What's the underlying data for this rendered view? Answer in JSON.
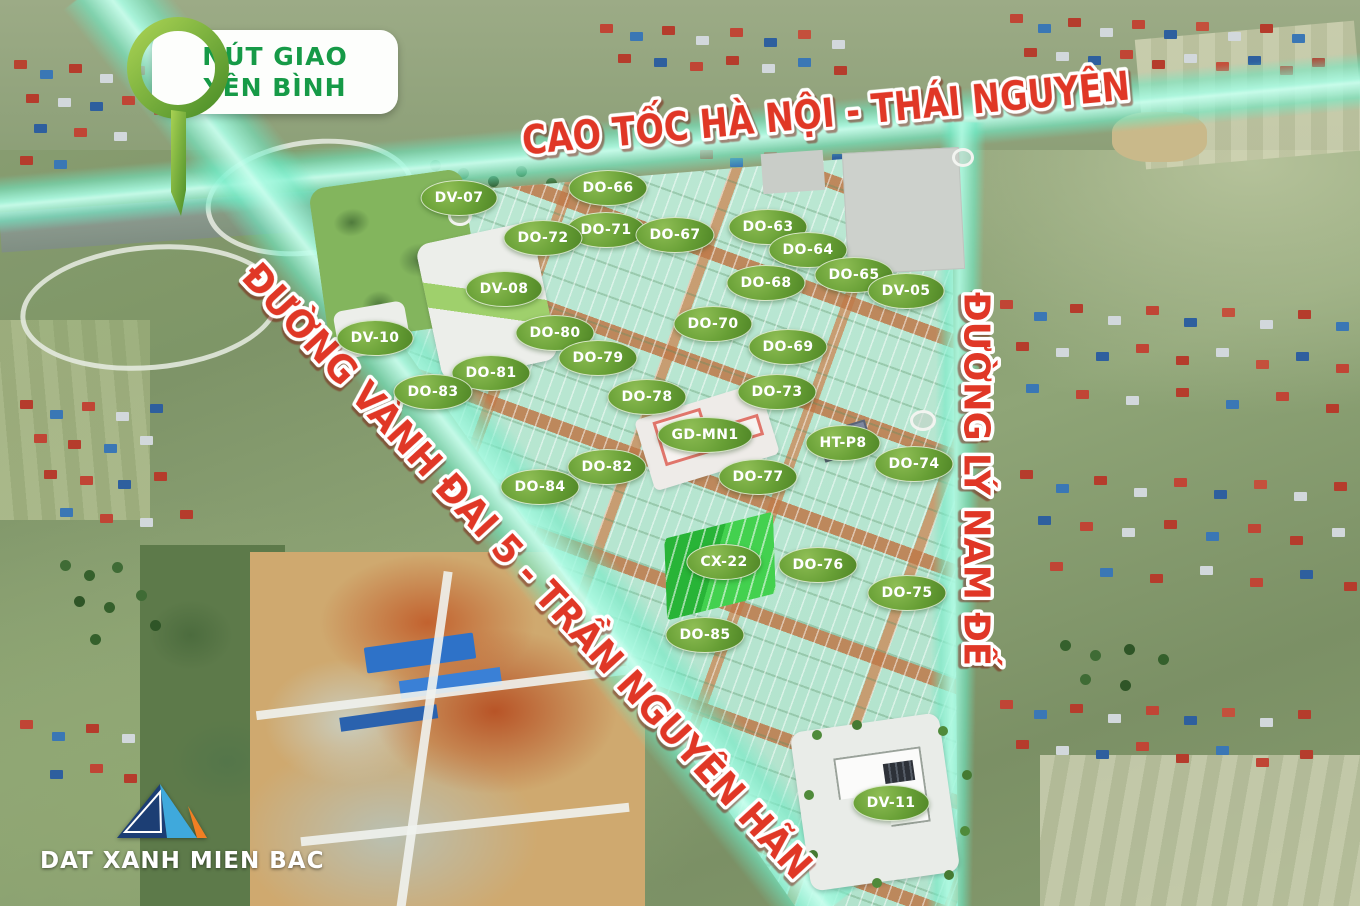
{
  "map": {
    "interchange_badge": {
      "line1": "NÚT GIAO",
      "line2": "YÊN BÌNH",
      "text_color": "#169a47"
    },
    "roads": [
      {
        "id": "expressway-top",
        "name": "CAO TỐC HÀ NỘI - THÁI NGUYÊN"
      },
      {
        "id": "ring-road-5",
        "name": "ĐƯỜNG VÀNH ĐAI 5 - TRẦN NGUYÊN HÃN"
      },
      {
        "id": "ly-nam-de",
        "name": "ĐƯỜNG LÝ NAM ĐẾ"
      }
    ],
    "lots": [
      {
        "label": "DV-07",
        "x": 459,
        "y": 198
      },
      {
        "label": "DO-66",
        "x": 608,
        "y": 188
      },
      {
        "label": "DO-63",
        "x": 768,
        "y": 227
      },
      {
        "label": "DO-71",
        "x": 606,
        "y": 230
      },
      {
        "label": "DO-67",
        "x": 675,
        "y": 235
      },
      {
        "label": "DO-72",
        "x": 543,
        "y": 238
      },
      {
        "label": "DO-64",
        "x": 808,
        "y": 250
      },
      {
        "label": "DO-65",
        "x": 854,
        "y": 275
      },
      {
        "label": "DO-68",
        "x": 766,
        "y": 283
      },
      {
        "label": "DV-08",
        "x": 504,
        "y": 289
      },
      {
        "label": "DV-05",
        "x": 906,
        "y": 291
      },
      {
        "label": "DO-70",
        "x": 713,
        "y": 324
      },
      {
        "label": "DO-80",
        "x": 555,
        "y": 333
      },
      {
        "label": "DV-10",
        "x": 375,
        "y": 338
      },
      {
        "label": "DO-69",
        "x": 788,
        "y": 347
      },
      {
        "label": "DO-79",
        "x": 598,
        "y": 358
      },
      {
        "label": "DO-81",
        "x": 491,
        "y": 373
      },
      {
        "label": "DO-83",
        "x": 433,
        "y": 392
      },
      {
        "label": "DO-73",
        "x": 777,
        "y": 392
      },
      {
        "label": "DO-78",
        "x": 647,
        "y": 397
      },
      {
        "label": "GD-MN1",
        "x": 705,
        "y": 435
      },
      {
        "label": "HT-P8",
        "x": 843,
        "y": 443
      },
      {
        "label": "DO-74",
        "x": 914,
        "y": 464
      },
      {
        "label": "DO-82",
        "x": 607,
        "y": 467
      },
      {
        "label": "DO-77",
        "x": 758,
        "y": 477
      },
      {
        "label": "DO-84",
        "x": 540,
        "y": 487
      },
      {
        "label": "CX-22",
        "x": 724,
        "y": 562
      },
      {
        "label": "DO-76",
        "x": 818,
        "y": 565
      },
      {
        "label": "DO-75",
        "x": 907,
        "y": 593
      },
      {
        "label": "DO-85",
        "x": 705,
        "y": 635
      },
      {
        "label": "DV-11",
        "x": 891,
        "y": 803
      }
    ],
    "colors": {
      "highway_highlight": "#6ee8c6",
      "lot_label_green": "#679f35",
      "road_text_red": "#e03726",
      "plan_lot_mint": "#bce8d4"
    }
  },
  "branding": {
    "logo_text": "DAT XANH MIEN BAC",
    "logo_colors": {
      "left": "#1c3e74",
      "mid": "#3fa9dc",
      "right": "#f07f23"
    }
  }
}
